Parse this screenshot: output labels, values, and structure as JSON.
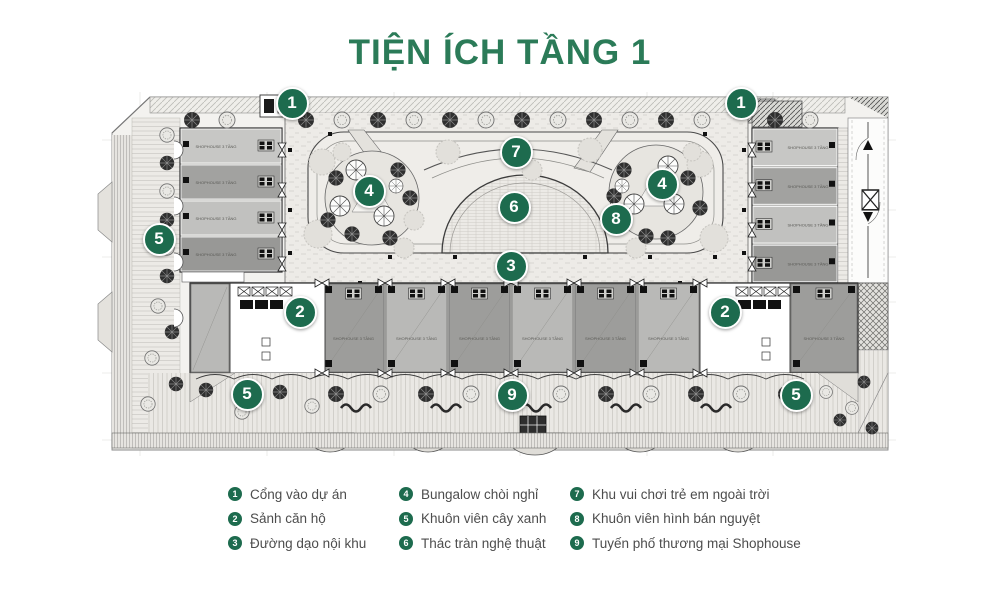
{
  "page": {
    "title": "TIỆN ÍCH TẦNG 1"
  },
  "colors": {
    "title_green": "#2b7b58",
    "marker_green": "#1d6b4e",
    "legend_text": "#4d4d4d"
  },
  "plan": {
    "unit_label": "SHOPHOUSE 3 TẦNG",
    "markers": [
      {
        "num": "1",
        "x": 292,
        "y": 103
      },
      {
        "num": "1",
        "x": 741,
        "y": 103
      },
      {
        "num": "7",
        "x": 516,
        "y": 152
      },
      {
        "num": "4",
        "x": 369,
        "y": 191
      },
      {
        "num": "4",
        "x": 662,
        "y": 184
      },
      {
        "num": "6",
        "x": 514,
        "y": 207
      },
      {
        "num": "8",
        "x": 616,
        "y": 219
      },
      {
        "num": "5",
        "x": 159,
        "y": 239
      },
      {
        "num": "3",
        "x": 511,
        "y": 266
      },
      {
        "num": "2",
        "x": 300,
        "y": 312
      },
      {
        "num": "2",
        "x": 725,
        "y": 312
      },
      {
        "num": "5",
        "x": 247,
        "y": 394
      },
      {
        "num": "9",
        "x": 512,
        "y": 395
      },
      {
        "num": "5",
        "x": 796,
        "y": 395
      }
    ]
  },
  "legend": {
    "items": [
      {
        "num": "1",
        "label": "Cổng vào dự án"
      },
      {
        "num": "2",
        "label": "Sảnh căn hộ"
      },
      {
        "num": "3",
        "label": "Đường dạo nội khu"
      },
      {
        "num": "4",
        "label": "Bungalow chòi nghỉ"
      },
      {
        "num": "5",
        "label": "Khuôn viên cây xanh"
      },
      {
        "num": "6",
        "label": "Thác tràn nghệ thuật"
      },
      {
        "num": "7",
        "label": "Khu vui chơi trẻ em ngoài trời"
      },
      {
        "num": "8",
        "label": "Khuôn viên hình bán nguyệt"
      },
      {
        "num": "9",
        "label": "Tuyến phố thương mại Shophouse"
      }
    ]
  }
}
